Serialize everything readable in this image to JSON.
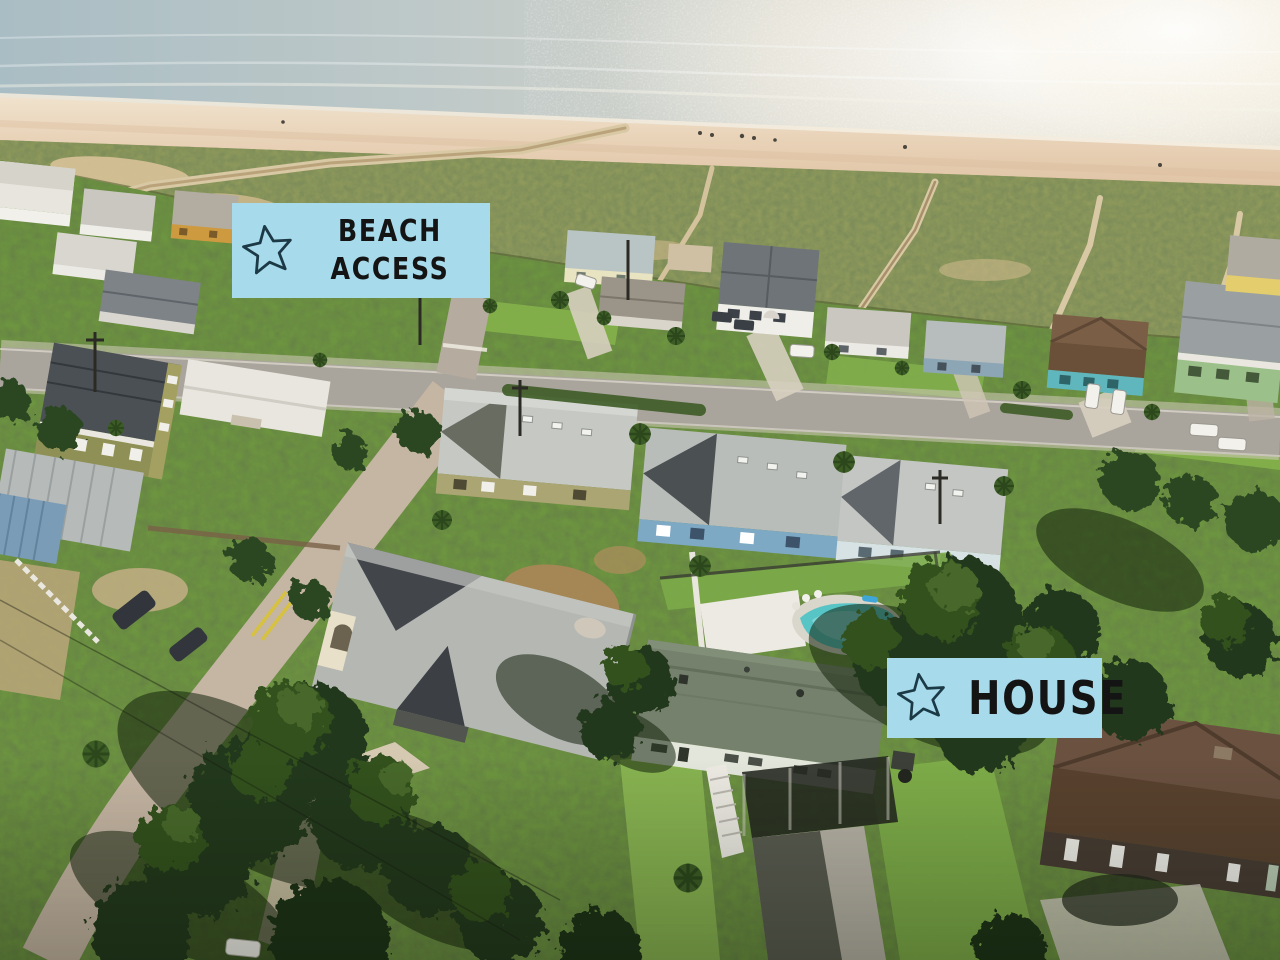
{
  "photo": {
    "alt": "aerial-drone-view-of-beachfront-neighborhood-with-ocean-beach-dunes-boardwalks-streets-houses-and-pool"
  },
  "labels": {
    "beach_access": {
      "line1": "BEACH",
      "line2": "ACCESS",
      "icon": "star-outline-icon",
      "bg_color": "#a7dbec",
      "text_color": "#141414",
      "star_color": "#1c3a46"
    },
    "house": {
      "text": "HOUSE",
      "icon": "star-outline-icon",
      "bg_color": "#a7dbec",
      "text_color": "#141414",
      "star_color": "#1c3a46"
    }
  },
  "scene_colors": {
    "ocean": "#bcc8ca",
    "sun_glint": "#f3eee2",
    "sand": "#e6cdb2",
    "dunes": "#8f9a5c",
    "road": "#a9a49c",
    "pool": "#57c4c6",
    "grass": "#6d9440"
  }
}
